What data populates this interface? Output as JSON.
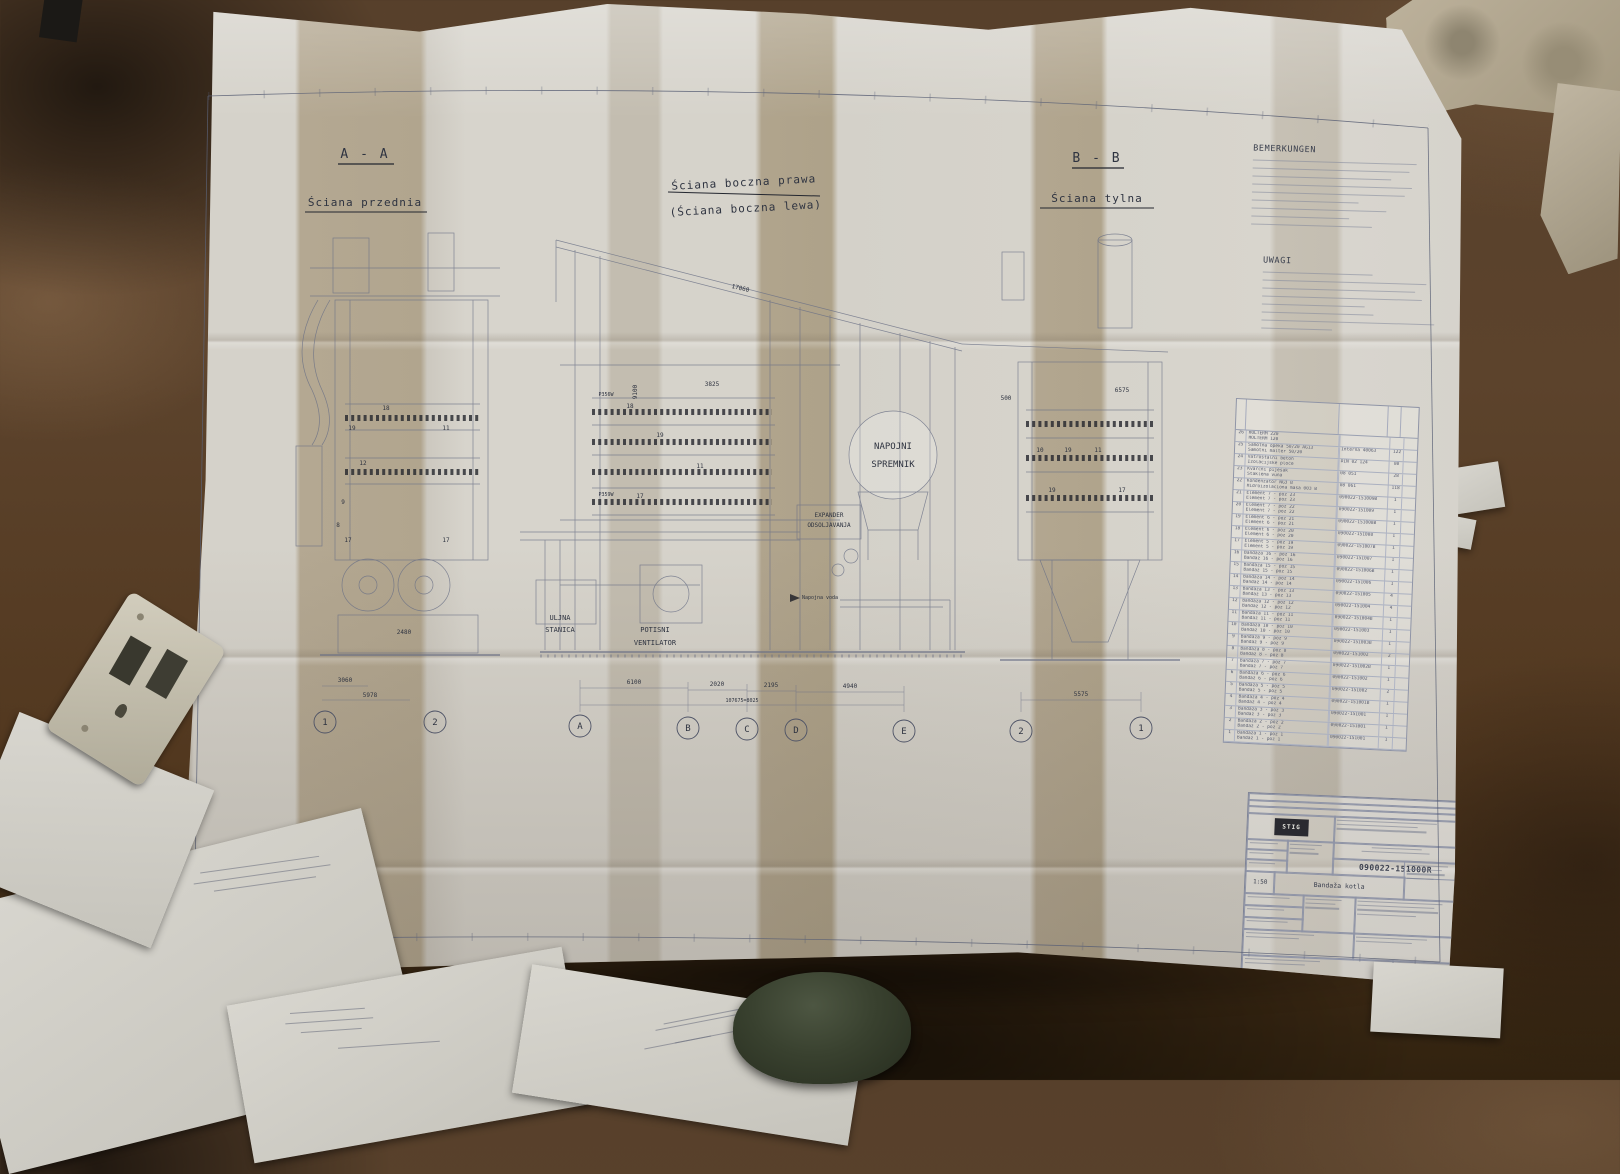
{
  "sheet": {
    "views": {
      "front": {
        "title": "A - A",
        "subtitle": "Ściana przednia"
      },
      "side": {
        "title": "Ściana boczna prawa",
        "subtitle": "(Ściana boczna lewa)"
      },
      "back": {
        "title": "B - B",
        "subtitle": "Ściana tylna"
      }
    },
    "labels": {
      "tank_line1": "NAPOJNI",
      "tank_line2": "SPREMNIK",
      "expander_line1": "EXPANDER",
      "expander_line2": "ODSOLJAVANJA",
      "oil_line1": "ULJNA",
      "oil_line2": "STANICA",
      "fan_line1": "POTISNI",
      "fan_line2": "VENTILATOR",
      "feedwater": "Napojna voda"
    },
    "axis": {
      "g1": "1",
      "g2": "2",
      "ga": "A",
      "gb": "B",
      "gc": "C",
      "gd": "D",
      "ge": "E",
      "g2r": "2",
      "g1r": "1"
    },
    "dims": {
      "left_a": "3060",
      "left_b": "5978",
      "ab": "6100",
      "bc": "2020",
      "cd": "2195",
      "de": "4940",
      "total": "107675=8025",
      "right": "5575",
      "roof": "17060",
      "height": "9100",
      "mid": "3825",
      "band_right": "6575",
      "base": "2480",
      "small": "500"
    },
    "callouts": {
      "n8": "8",
      "n9": "9",
      "n10": "10",
      "n11": "11",
      "n12": "12",
      "n17": "17",
      "n18": "18",
      "n19": "19",
      "pump1": "P356W",
      "pump2": "P359W"
    },
    "notes_de": {
      "title": "BEMERKUNGEN",
      "line_widths_pct": [
        92,
        88,
        78,
        90,
        86,
        60,
        76,
        55,
        68
      ]
    },
    "notes_pl": {
      "title": "UWAGI",
      "line_widths_pct": [
        62,
        92,
        86,
        90,
        58,
        63,
        97,
        40
      ]
    },
    "parts_table": {
      "rows": [
        {
          "no": "26",
          "l1": "HOLTERM 220",
          "l2": "HOLTERM 120",
          "dwg": "",
          "qty": ""
        },
        {
          "no": "25",
          "l1": "Šamotna opeka 50/20 AG13",
          "l2": "Šamotni malter 50/20",
          "dwg": "Interna 40063",
          "qty": "122"
        },
        {
          "no": "24",
          "l1": "Vatrostalni beton",
          "l2": "Izolacijske ploče",
          "dwg": "DIN 02 124",
          "qty": "80"
        },
        {
          "no": "23",
          "l1": "Kvarcni pijesak",
          "l2": "Staklena vuna",
          "dwg": "08 051",
          "qty": "28"
        },
        {
          "no": "22",
          "l1": "Kondenzator NG3 B",
          "l2": "Hidroizolaciona masa 003 B",
          "dwg": "08 061",
          "qty": "118"
        },
        {
          "no": "21",
          "l1": "Element 7 - poz 23",
          "l2": "Element 7 - poz 23",
          "dwg": "090022-151009B",
          "qty": "1"
        },
        {
          "no": "20",
          "l1": "Element 7 - poz 22",
          "l2": "Element 7 - poz 22",
          "dwg": "090022-151009",
          "qty": "1"
        },
        {
          "no": "19",
          "l1": "Element 6 - poz 21",
          "l2": "Element 6 - poz 21",
          "dwg": "090022-151008B",
          "qty": "1"
        },
        {
          "no": "18",
          "l1": "Element 6 - poz 20",
          "l2": "Element 6 - poz 20",
          "dwg": "090022-151008",
          "qty": "1"
        },
        {
          "no": "17",
          "l1": "Element 5 - poz 19",
          "l2": "Element 5 - poz 19",
          "dwg": "090022-151007B",
          "qty": "1"
        },
        {
          "no": "16",
          "l1": "Bandaža 16 - poz 16",
          "l2": "Bandaž 16 - poz 16",
          "dwg": "090022-151007",
          "qty": "1"
        },
        {
          "no": "15",
          "l1": "Bandaža 15 - poz 15",
          "l2": "Bandaž 15 - poz 15",
          "dwg": "090022-151006B",
          "qty": "1"
        },
        {
          "no": "14",
          "l1": "Bandaža 14 - poz 14",
          "l2": "Bandaž 14 - poz 14",
          "dwg": "090022-151006",
          "qty": "1"
        },
        {
          "no": "13",
          "l1": "Bandaža 13 - poz 13",
          "l2": "Bandaž 13 - poz 13",
          "dwg": "090022-151005",
          "qty": "4"
        },
        {
          "no": "12",
          "l1": "Bandaža 12 - poz 12",
          "l2": "Bandaž 12 - poz 12",
          "dwg": "090022-151004",
          "qty": "4"
        },
        {
          "no": "11",
          "l1": "Bandaža 11 - poz 11",
          "l2": "Bandaž 11 - poz 11",
          "dwg": "090022-151004B",
          "qty": "1"
        },
        {
          "no": "10",
          "l1": "Bandaža 10 - poz 10",
          "l2": "Bandaž 10 - poz 10",
          "dwg": "090022-151003",
          "qty": "1"
        },
        {
          "no": "9",
          "l1": "Bandaža 9 - poz 9",
          "l2": "Bandaž 9 - poz 9",
          "dwg": "090022-151003B",
          "qty": "1"
        },
        {
          "no": "8",
          "l1": "Bandaža 8 - poz 8",
          "l2": "Bandaž 8 - poz 8",
          "dwg": "090022-151002",
          "qty": "2"
        },
        {
          "no": "7",
          "l1": "Bandaža 7 - poz 7",
          "l2": "Bandaž 7 - poz 7",
          "dwg": "090022-151002B",
          "qty": "1"
        },
        {
          "no": "6",
          "l1": "Bandaža 6 - poz 6",
          "l2": "Bandaž 6 - poz 6",
          "dwg": "090022-151002",
          "qty": "1"
        },
        {
          "no": "5",
          "l1": "Bandaža 5 - poz 5",
          "l2": "Bandaž 5 - poz 5",
          "dwg": "090022-151002",
          "qty": "2"
        },
        {
          "no": "4",
          "l1": "Bandaža 4 - poz 4",
          "l2": "Bandaž 4 - poz 4",
          "dwg": "090022-151001B",
          "qty": "1"
        },
        {
          "no": "3",
          "l1": "Bandaža 3 - poz 3",
          "l2": "Bandaž 3 - poz 3",
          "dwg": "090022-151001",
          "qty": "1"
        },
        {
          "no": "2",
          "l1": "Bandaža 2 - poz 2",
          "l2": "Bandaž 2 - poz 2",
          "dwg": "090022-151001",
          "qty": "1"
        },
        {
          "no": "1",
          "l1": "Bandaža 1 - poz 1",
          "l2": "Bandaž 1 - poz 1",
          "dwg": "090022-151001",
          "qty": "1"
        }
      ]
    },
    "title_block": {
      "logo": "STIG",
      "drawing_no": "090022-151000R",
      "scale": "1:50",
      "title": "Bandaža kotla",
      "format": "A2"
    }
  }
}
